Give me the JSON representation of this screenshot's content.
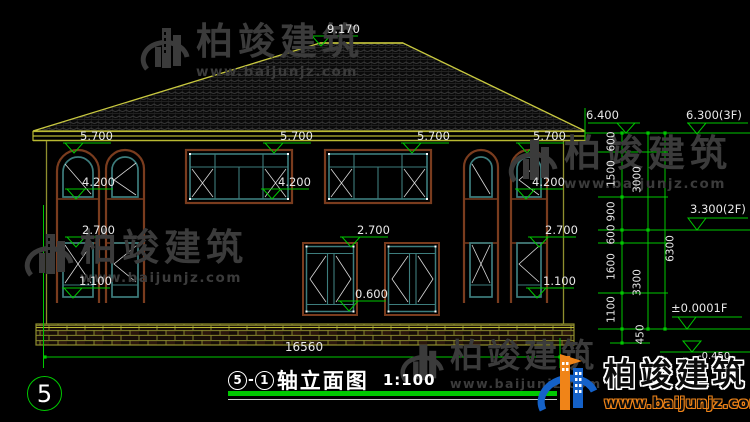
{
  "drawing": {
    "sheet_number": "5",
    "title": {
      "axis_start": "5",
      "axis_sep": "-",
      "axis_end": "1",
      "name": "轴立面图",
      "scale": "1:100"
    }
  },
  "elevations": {
    "ridge": "9.170",
    "eave_right": "6.400",
    "floor3": "6.300(3F)",
    "floor2": "3.300(2F)",
    "floor1": "±0.0001F",
    "ground": "-0.450",
    "eave_marks": [
      "5.700",
      "5.700",
      "5.700",
      "5.700"
    ],
    "window_top_2f": [
      "4.200",
      "4.200",
      "4.200"
    ],
    "window_top_1f": [
      "2.700",
      "2.700",
      "2.700"
    ],
    "window_sill_1f": [
      "1.100",
      "1.100"
    ],
    "window_sill_center": "0.600"
  },
  "dimensions": {
    "total_width": "16560",
    "chain_inner": [
      "600",
      "1500",
      "900",
      "600",
      "1600",
      "1100",
      "450"
    ],
    "chain_mid": [
      "3000",
      "3300"
    ],
    "chain_outer": [
      "6300"
    ]
  },
  "watermark": {
    "brand": "柏竣建筑",
    "url": "www.baijunjz.com"
  },
  "logo": {
    "brand": "柏竣建筑",
    "url": "www.baijunjz.com"
  },
  "colors": {
    "dim_green": "#00c800",
    "roof_outline": "#c9c93f",
    "wall_outline": "#8f8f2e",
    "frame_brown": "#7a3c1e",
    "frame_teal": "#3d7d7d",
    "brand_blue": "#1461c8",
    "brand_orange": "#f08418"
  }
}
